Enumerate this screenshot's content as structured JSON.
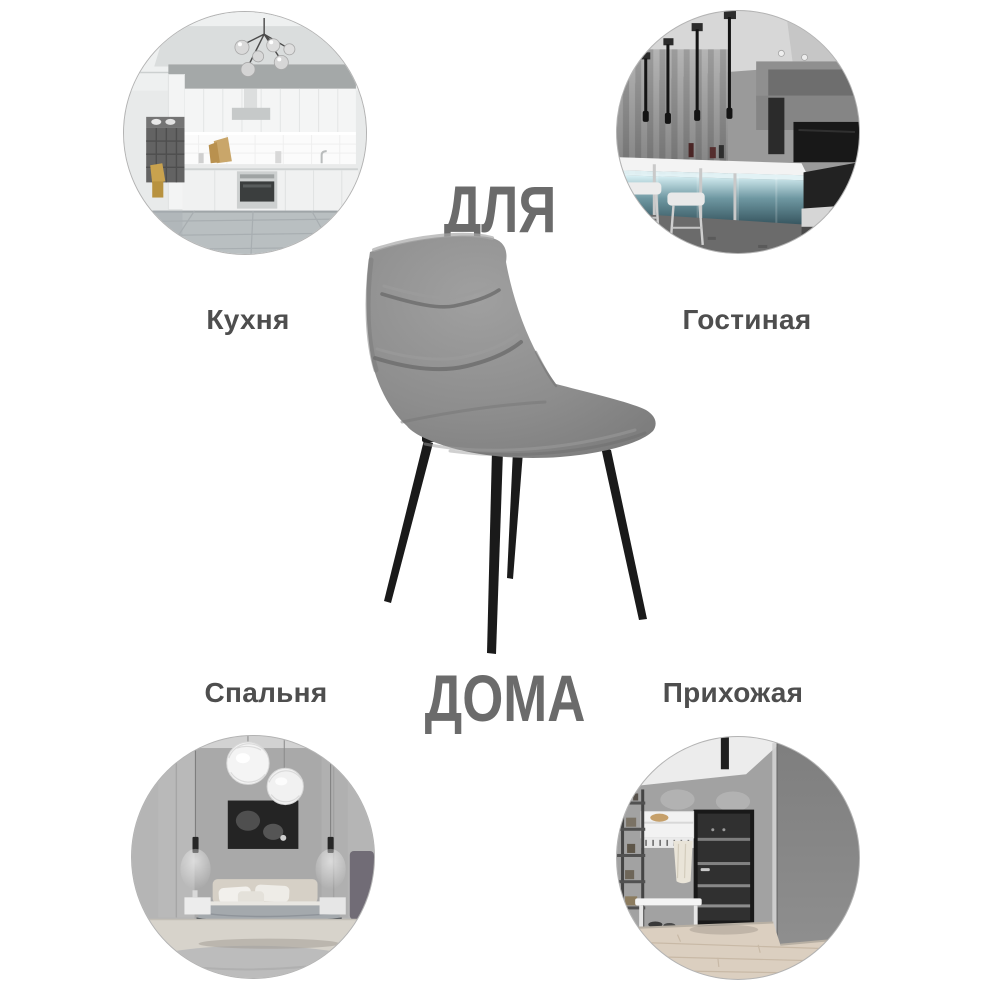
{
  "title": {
    "line1": "ДЛЯ",
    "line2": "ДОМА"
  },
  "rooms": [
    {
      "id": "kitchen",
      "label": "Кухня",
      "photo": "kitchen-interior-photo",
      "position": "top-left"
    },
    {
      "id": "living-room",
      "label": "Гостиная",
      "photo": "bar-living-room-interior-photo",
      "position": "top-right"
    },
    {
      "id": "bedroom",
      "label": "Спальня",
      "photo": "bedroom-interior-photo",
      "position": "bottom-left"
    },
    {
      "id": "hallway",
      "label": "Прихожая",
      "photo": "hallway-interior-photo",
      "position": "bottom-right"
    }
  ],
  "product": {
    "image": "gray-velvet-chair-with-black-metal-legs"
  },
  "colors": {
    "background": "#ffffff",
    "heading_text": "#6b6b6b",
    "label_text": "#4e4e4e",
    "circle_border": "#b3b3b3",
    "chair_fabric": "#8d8d8d",
    "chair_legs": "#1a1a1a",
    "bar_glow": "#6e97a1"
  }
}
